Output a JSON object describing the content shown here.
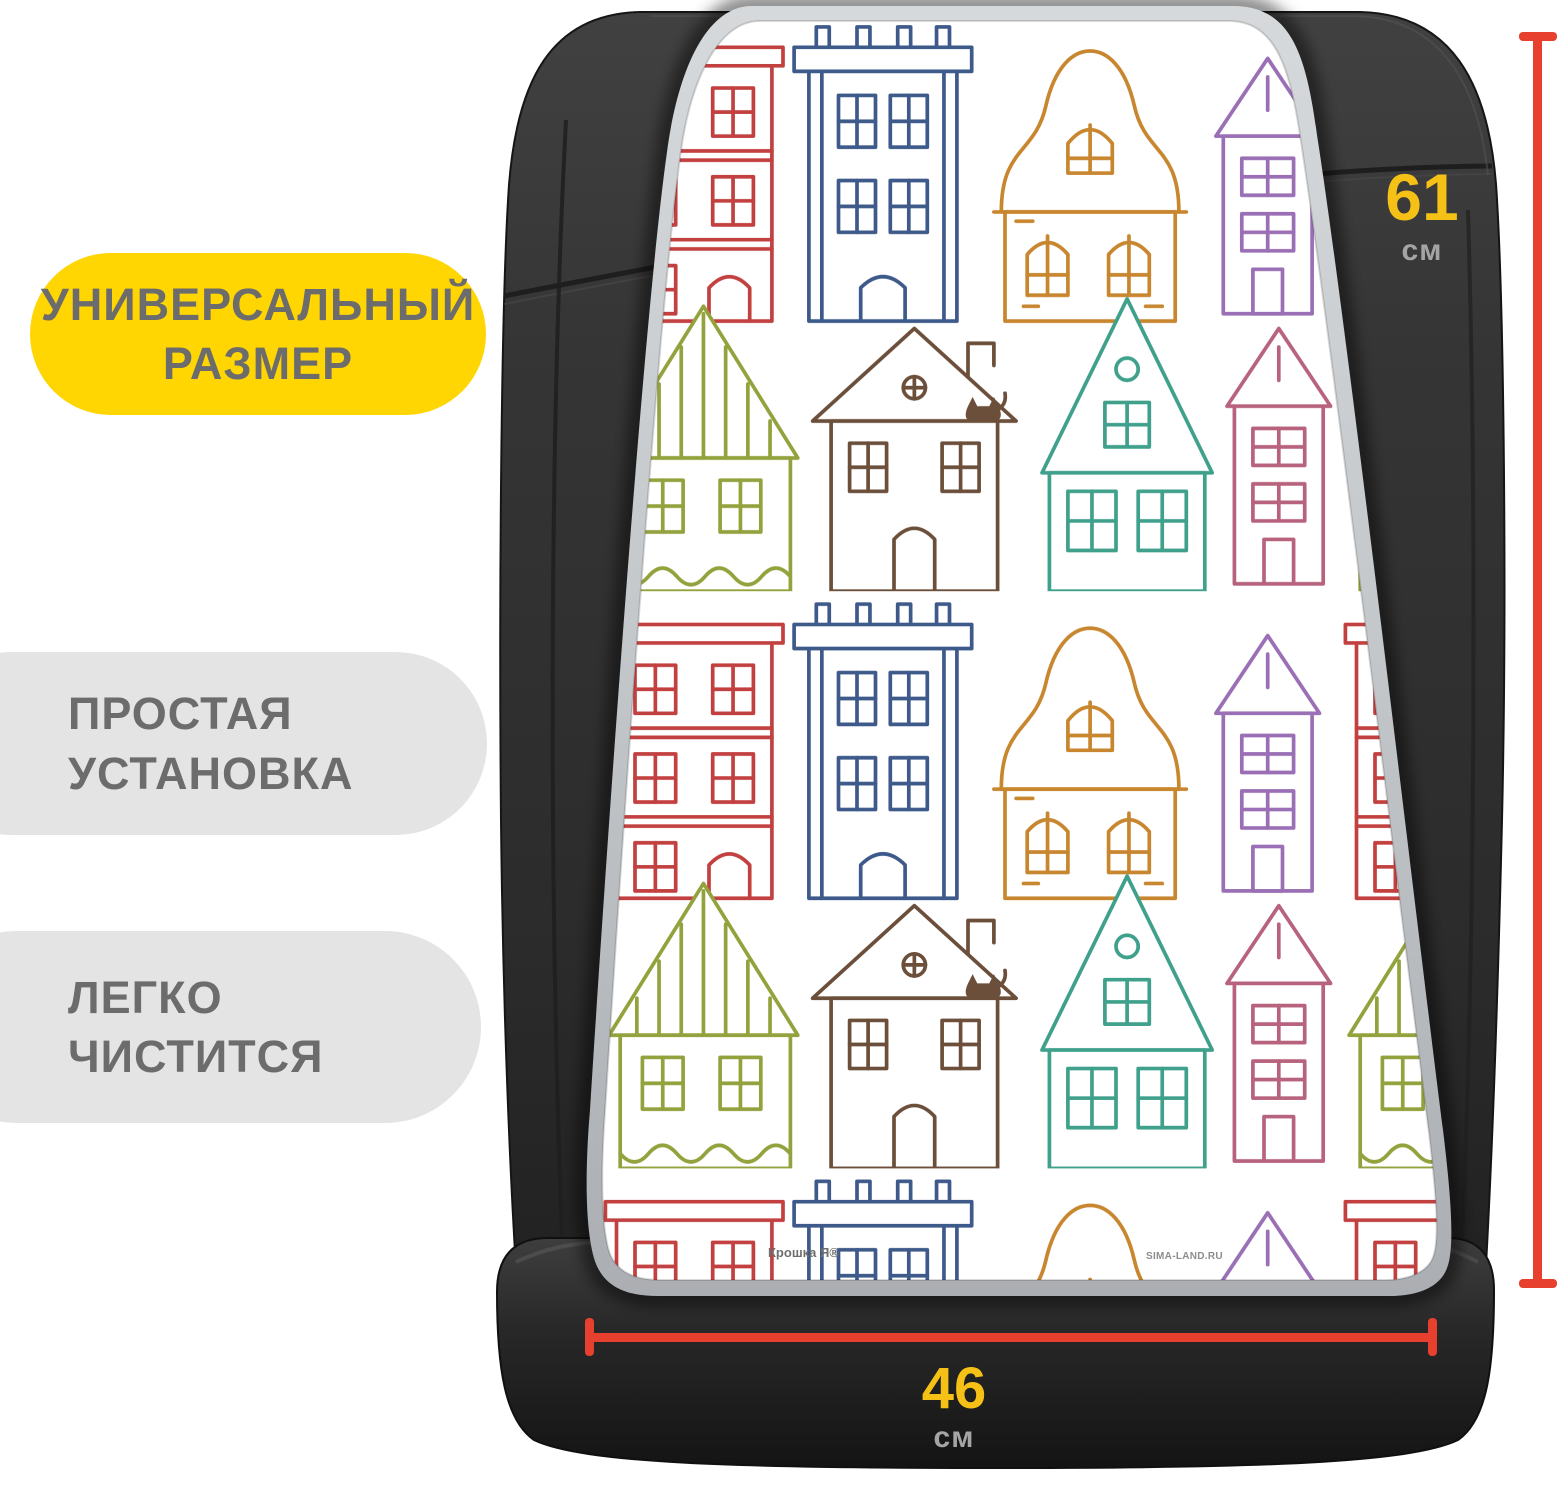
{
  "page": {
    "type": "product marketing image",
    "subject": "car seat back protector cover with doodle house pattern",
    "background": "#ffffff"
  },
  "badges": [
    {
      "id": "universal-size",
      "lines": [
        "УНИВЕРСАЛЬНЫЙ",
        "РАЗМЕР"
      ],
      "bg_color": "#ffd502",
      "text_color": "#6c6c6c"
    },
    {
      "id": "easy-install",
      "lines": [
        "ПРОСТАЯ",
        "УСТАНОВКА"
      ],
      "bg_color": "#e4e4e5",
      "text_color": "#6c6c6c"
    },
    {
      "id": "easy-clean",
      "lines": [
        "ЛЕГКО",
        "ЧИСТИТСЯ"
      ],
      "bg_color": "#e4e4e5",
      "text_color": "#6c6c6c"
    }
  ],
  "dimensions": {
    "height": {
      "value": "61",
      "unit": "см"
    },
    "width": {
      "value": "46",
      "unit": "см"
    },
    "line_color": "#e8402f",
    "value_color": "#f5c117",
    "unit_color": "#a5a5a5"
  },
  "watermarks": {
    "brand": "Крошка Я®",
    "site": "SIMA-LAND.RU"
  },
  "artwork": {
    "seat_color": "#303030",
    "cover_rim_color": "#c3c7ca",
    "pattern_background": "#ffffff",
    "pattern_palette": [
      "#c24040",
      "#3d5a8a",
      "#c8862f",
      "#9a6fb5",
      "#93a23c",
      "#6b4f3a",
      "#3fa08b",
      "#b8637d"
    ]
  }
}
